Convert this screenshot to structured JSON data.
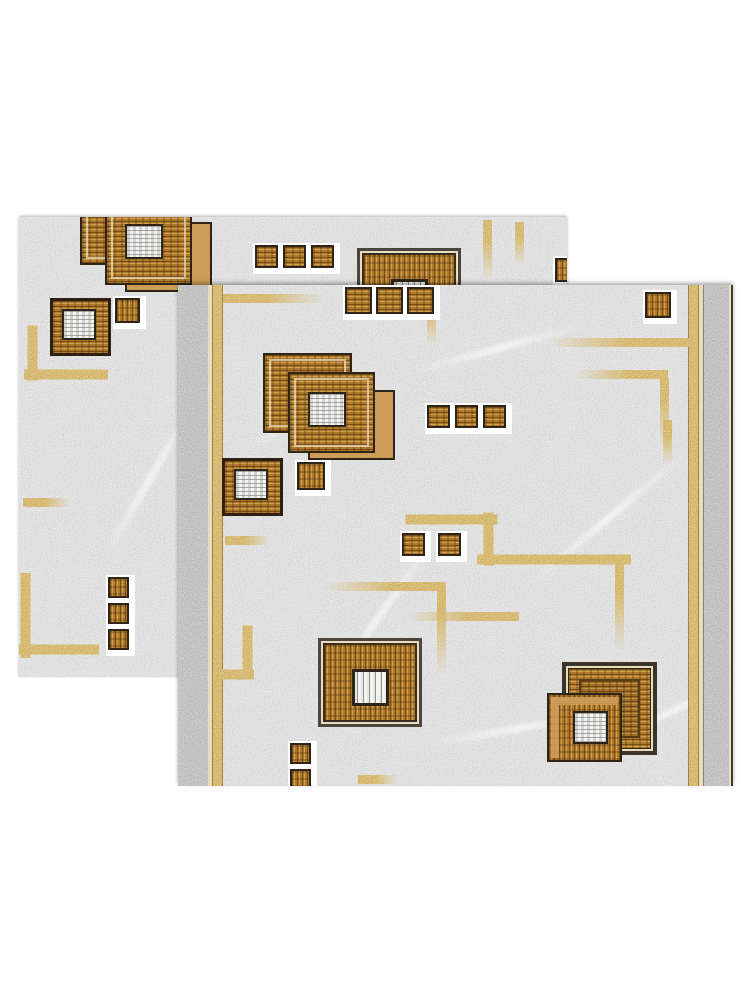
{
  "canvas": {
    "width": 750,
    "height": 1000,
    "background": "#ffffff"
  },
  "colors": {
    "bg": "#ffffff",
    "field_gray": "#c6c6c6",
    "band_gray": "#9a9a9a",
    "gold": "#c2903e",
    "gold_dark": "#6b4a12",
    "wood": "#b07a2c",
    "wood_dark": "#7a4f16",
    "wood_light": "#cfa050",
    "tan": "#cd9c58",
    "border_dark": "#2e2418",
    "frame_gray": "#4a463e",
    "cream": "#e9ddc0",
    "white": "#ffffff"
  },
  "rugs": [
    {
      "name": "rug-back",
      "x": 19,
      "y": 217,
      "w": 548,
      "h": 460,
      "shadow": "0 -1px 3px rgba(0,0,0,0.3)",
      "strips": [],
      "veins": [
        [
          120,
          140,
          200,
          -30
        ],
        [
          40,
          260,
          180,
          -60
        ],
        [
          300,
          60,
          160,
          -20
        ],
        [
          160,
          380,
          220,
          -45
        ],
        [
          420,
          120,
          150,
          -35
        ]
      ],
      "gold_lines": [
        [
          9,
          111,
          9,
          50,
          ""
        ],
        [
          9,
          153,
          76,
          9,
          ""
        ],
        [
          4,
          281,
          47,
          9,
          "fade-r"
        ],
        [
          2,
          360,
          9,
          77,
          ""
        ],
        [
          2,
          428,
          74,
          9,
          ""
        ],
        [
          464,
          3,
          9,
          60,
          "fade-b"
        ],
        [
          496,
          5,
          9,
          43,
          "fade-b"
        ]
      ],
      "motifs": [
        {
          "t": "stacked",
          "x": 61,
          "y": -40
        },
        {
          "t": "framed",
          "x": 338,
          "y": 31
        },
        {
          "t": "whitesq",
          "x": 31,
          "y": 81
        },
        {
          "t": "sq",
          "x": 96,
          "y": 81,
          "s": 25
        },
        {
          "t": "row",
          "x": 236,
          "y": 28,
          "s": 23,
          "g": 5,
          "n": 3
        },
        {
          "t": "sq",
          "x": 536,
          "y": 41,
          "s": 24
        },
        {
          "t": "col",
          "x": 89,
          "y": 360,
          "s": 21,
          "g": 5,
          "n": 3
        }
      ]
    },
    {
      "name": "rug-front",
      "x": 178,
      "y": 285,
      "w": 555,
      "h": 501,
      "shadow": "0 -2px 4px rgba(0,0,0,0.35)",
      "strips": [
        {
          "x": 0,
          "w": 30,
          "k": "band"
        },
        {
          "x": 30,
          "w": 4,
          "k": "cream"
        },
        {
          "x": 34,
          "w": 11,
          "k": "gold"
        },
        {
          "x": 510,
          "w": 11,
          "k": "gold"
        },
        {
          "x": 521,
          "w": 4,
          "k": "cream"
        },
        {
          "x": 525,
          "w": 2,
          "k": "dark"
        },
        {
          "x": 527,
          "w": 24,
          "k": "band"
        },
        {
          "x": 551,
          "w": 2,
          "k": "cream"
        },
        {
          "x": 553,
          "w": 2,
          "k": "dark"
        }
      ],
      "veins": [
        [
          60,
          120,
          140,
          -35
        ],
        [
          230,
          60,
          180,
          -15
        ],
        [
          90,
          330,
          220,
          -55
        ],
        [
          330,
          230,
          200,
          -40
        ],
        [
          420,
          420,
          160,
          -25
        ],
        [
          250,
          440,
          180,
          -10
        ]
      ],
      "gold_lines": [
        [
          45,
          9,
          100,
          9,
          "fade-r"
        ],
        [
          370,
          53,
          141,
          9,
          "fade-l"
        ],
        [
          398,
          85,
          92,
          9,
          "fade-l"
        ],
        [
          482,
          93,
          9,
          68,
          "fade-b"
        ],
        [
          249,
          10,
          9,
          50,
          "fade-b"
        ],
        [
          47,
          251,
          45,
          9,
          "fade-r"
        ],
        [
          232,
          230,
          83,
          9,
          ""
        ],
        [
          306,
          230,
          9,
          48,
          ""
        ],
        [
          306,
          270,
          140,
          9,
          ""
        ],
        [
          437,
          278,
          9,
          88,
          "fade-b"
        ],
        [
          147,
          297,
          121,
          9,
          "fade-l"
        ],
        [
          259,
          297,
          9,
          94,
          "fade-b"
        ],
        [
          229,
          327,
          112,
          9,
          "fade-l"
        ],
        [
          485,
          135,
          9,
          45,
          "fade-b"
        ],
        [
          65,
          343,
          9,
          44,
          ""
        ],
        [
          38,
          385,
          36,
          9,
          ""
        ],
        [
          180,
          490,
          40,
          9,
          "fade-r"
        ]
      ],
      "motifs": [
        {
          "t": "row",
          "x": 167,
          "y": 2,
          "s": 27,
          "g": 4,
          "n": 3
        },
        {
          "t": "sq",
          "x": 467,
          "y": 7,
          "s": 26
        },
        {
          "t": "stacked",
          "x": 85,
          "y": 60
        },
        {
          "t": "whitesq",
          "x": 44,
          "y": 173
        },
        {
          "t": "sq",
          "x": 119,
          "y": 177,
          "s": 28
        },
        {
          "t": "row",
          "x": 249,
          "y": 120,
          "s": 23,
          "g": 5,
          "n": 3
        },
        {
          "t": "row",
          "x": 224,
          "y": 248,
          "s": 23,
          "g": 13,
          "n": 2
        },
        {
          "t": "framed",
          "x": 140,
          "y": 353
        },
        {
          "t": "overlap",
          "x": 369,
          "y": 377
        },
        {
          "t": "col",
          "x": 112,
          "y": 458,
          "s": 21,
          "g": 5,
          "n": 3
        }
      ]
    }
  ],
  "components": {
    "stacked": {
      "w": 132,
      "h": 115,
      "back_square": [
        0,
        8,
        89,
        80
      ],
      "tan_shadow": [
        45,
        45,
        87,
        70
      ],
      "front_square": [
        25,
        27,
        87,
        81
      ],
      "white_center": [
        45,
        47,
        38,
        35
      ]
    },
    "framed": {
      "w": 104,
      "h": 89,
      "white_center": [
        31,
        28,
        37,
        37
      ]
    },
    "whitesq": {
      "w": 61,
      "h": 58,
      "white_center": [
        9,
        8,
        34,
        31
      ]
    },
    "overlap": {
      "w": 112,
      "h": 102,
      "back_square": [
        15,
        0,
        95,
        93
      ],
      "front_square": [
        0,
        31,
        75,
        69
      ],
      "white_center": [
        24,
        16,
        35,
        33
      ]
    }
  }
}
